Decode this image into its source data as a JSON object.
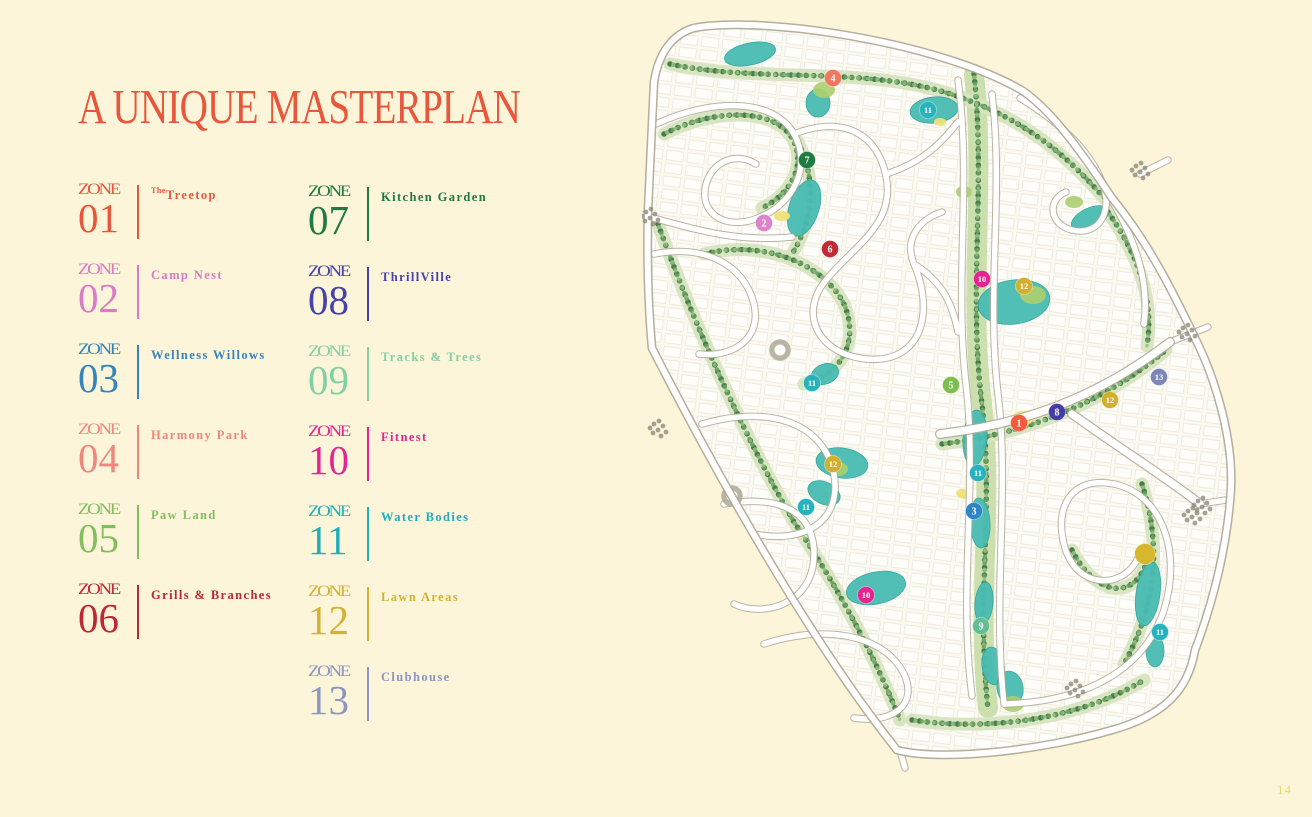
{
  "page": {
    "background": "#FCF5DA",
    "page_number": "14"
  },
  "title": {
    "text": "A UNIQUE MASTERPLAN",
    "color": "#E8573B"
  },
  "legend": {
    "zone_word": "ZONE",
    "zones": [
      {
        "num": "01",
        "label_prefix": "The",
        "label": "Treetop",
        "color": "#E8573B"
      },
      {
        "num": "02",
        "label": "Camp Nest",
        "color": "#D97BC6"
      },
      {
        "num": "03",
        "label": "Wellness Willows",
        "color": "#3585BC"
      },
      {
        "num": "04",
        "label": "Harmony Park",
        "color": "#F0877D"
      },
      {
        "num": "05",
        "label": "Paw Land",
        "color": "#82BE60"
      },
      {
        "num": "06",
        "label": "Grills & Branches",
        "color": "#BC2834"
      },
      {
        "num": "07",
        "label": "Kitchen Garden",
        "color": "#1F7A43"
      },
      {
        "num": "08",
        "label": "ThrillVille",
        "color": "#4543AA"
      },
      {
        "num": "09",
        "label": "Tracks & Trees",
        "color": "#85CFA4"
      },
      {
        "num": "10",
        "label": "Fitnest",
        "color": "#E5258F"
      },
      {
        "num": "11",
        "label": "Water Bodies",
        "color": "#21AEBB"
      },
      {
        "num": "12",
        "label": "Lawn Areas",
        "color": "#D2B230"
      },
      {
        "num": "13",
        "label": "Clubhouse",
        "color": "#8D96C0"
      }
    ]
  },
  "map": {
    "palette": {
      "water": "#49BCB3",
      "road": "#FFFFFF",
      "road_casing": "#AFA896",
      "green_dark": "#3E7647",
      "green_mid": "#68A164",
      "green_light": "#96BF78",
      "lawn": "#ABCF6F",
      "sand": "#EFE178",
      "plot_line": "#D9D5C6"
    },
    "markers": [
      {
        "n": "4",
        "x": 191,
        "y": 76,
        "color": "#F0765E"
      },
      {
        "n": "11",
        "x": 286,
        "y": 108,
        "color": "#27B3BD"
      },
      {
        "n": "7",
        "x": 165,
        "y": 158,
        "color": "#1E7B44"
      },
      {
        "n": "2",
        "x": 122,
        "y": 221,
        "color": "#DC84CA"
      },
      {
        "n": "6",
        "x": 188,
        "y": 247,
        "color": "#C22A35"
      },
      {
        "n": "10",
        "x": 340,
        "y": 277,
        "color": "#E3268F"
      },
      {
        "n": "12",
        "x": 382,
        "y": 284,
        "color": "#D2AF2D"
      },
      {
        "n": "13",
        "x": 517,
        "y": 375,
        "color": "#7D86B8"
      },
      {
        "n": "11",
        "x": 170,
        "y": 381,
        "color": "#27B3BD"
      },
      {
        "n": "5",
        "x": 309,
        "y": 383,
        "color": "#7CBF4E"
      },
      {
        "n": "12",
        "x": 468,
        "y": 398,
        "color": "#D2AF2D"
      },
      {
        "n": "8",
        "x": 415,
        "y": 410,
        "color": "#443DA5"
      },
      {
        "n": "1",
        "x": 377,
        "y": 421,
        "color": "#F15C3C"
      },
      {
        "n": "12",
        "x": 191,
        "y": 462,
        "color": "#D2AF2D"
      },
      {
        "n": "11",
        "x": 336,
        "y": 471,
        "color": "#27B3BD"
      },
      {
        "n": "11",
        "x": 164,
        "y": 505,
        "color": "#27B3BD"
      },
      {
        "n": "3",
        "x": 332,
        "y": 509,
        "color": "#2E86C6"
      },
      {
        "n": "10",
        "x": 224,
        "y": 593,
        "color": "#E3268F"
      },
      {
        "n": "9",
        "x": 339,
        "y": 624,
        "color": "#64BE93"
      },
      {
        "n": "",
        "x": 503,
        "y": 552,
        "color": "#D8B62E",
        "r": 10.5
      },
      {
        "n": "11",
        "x": 518,
        "y": 630,
        "color": "#27B3BD"
      }
    ]
  }
}
